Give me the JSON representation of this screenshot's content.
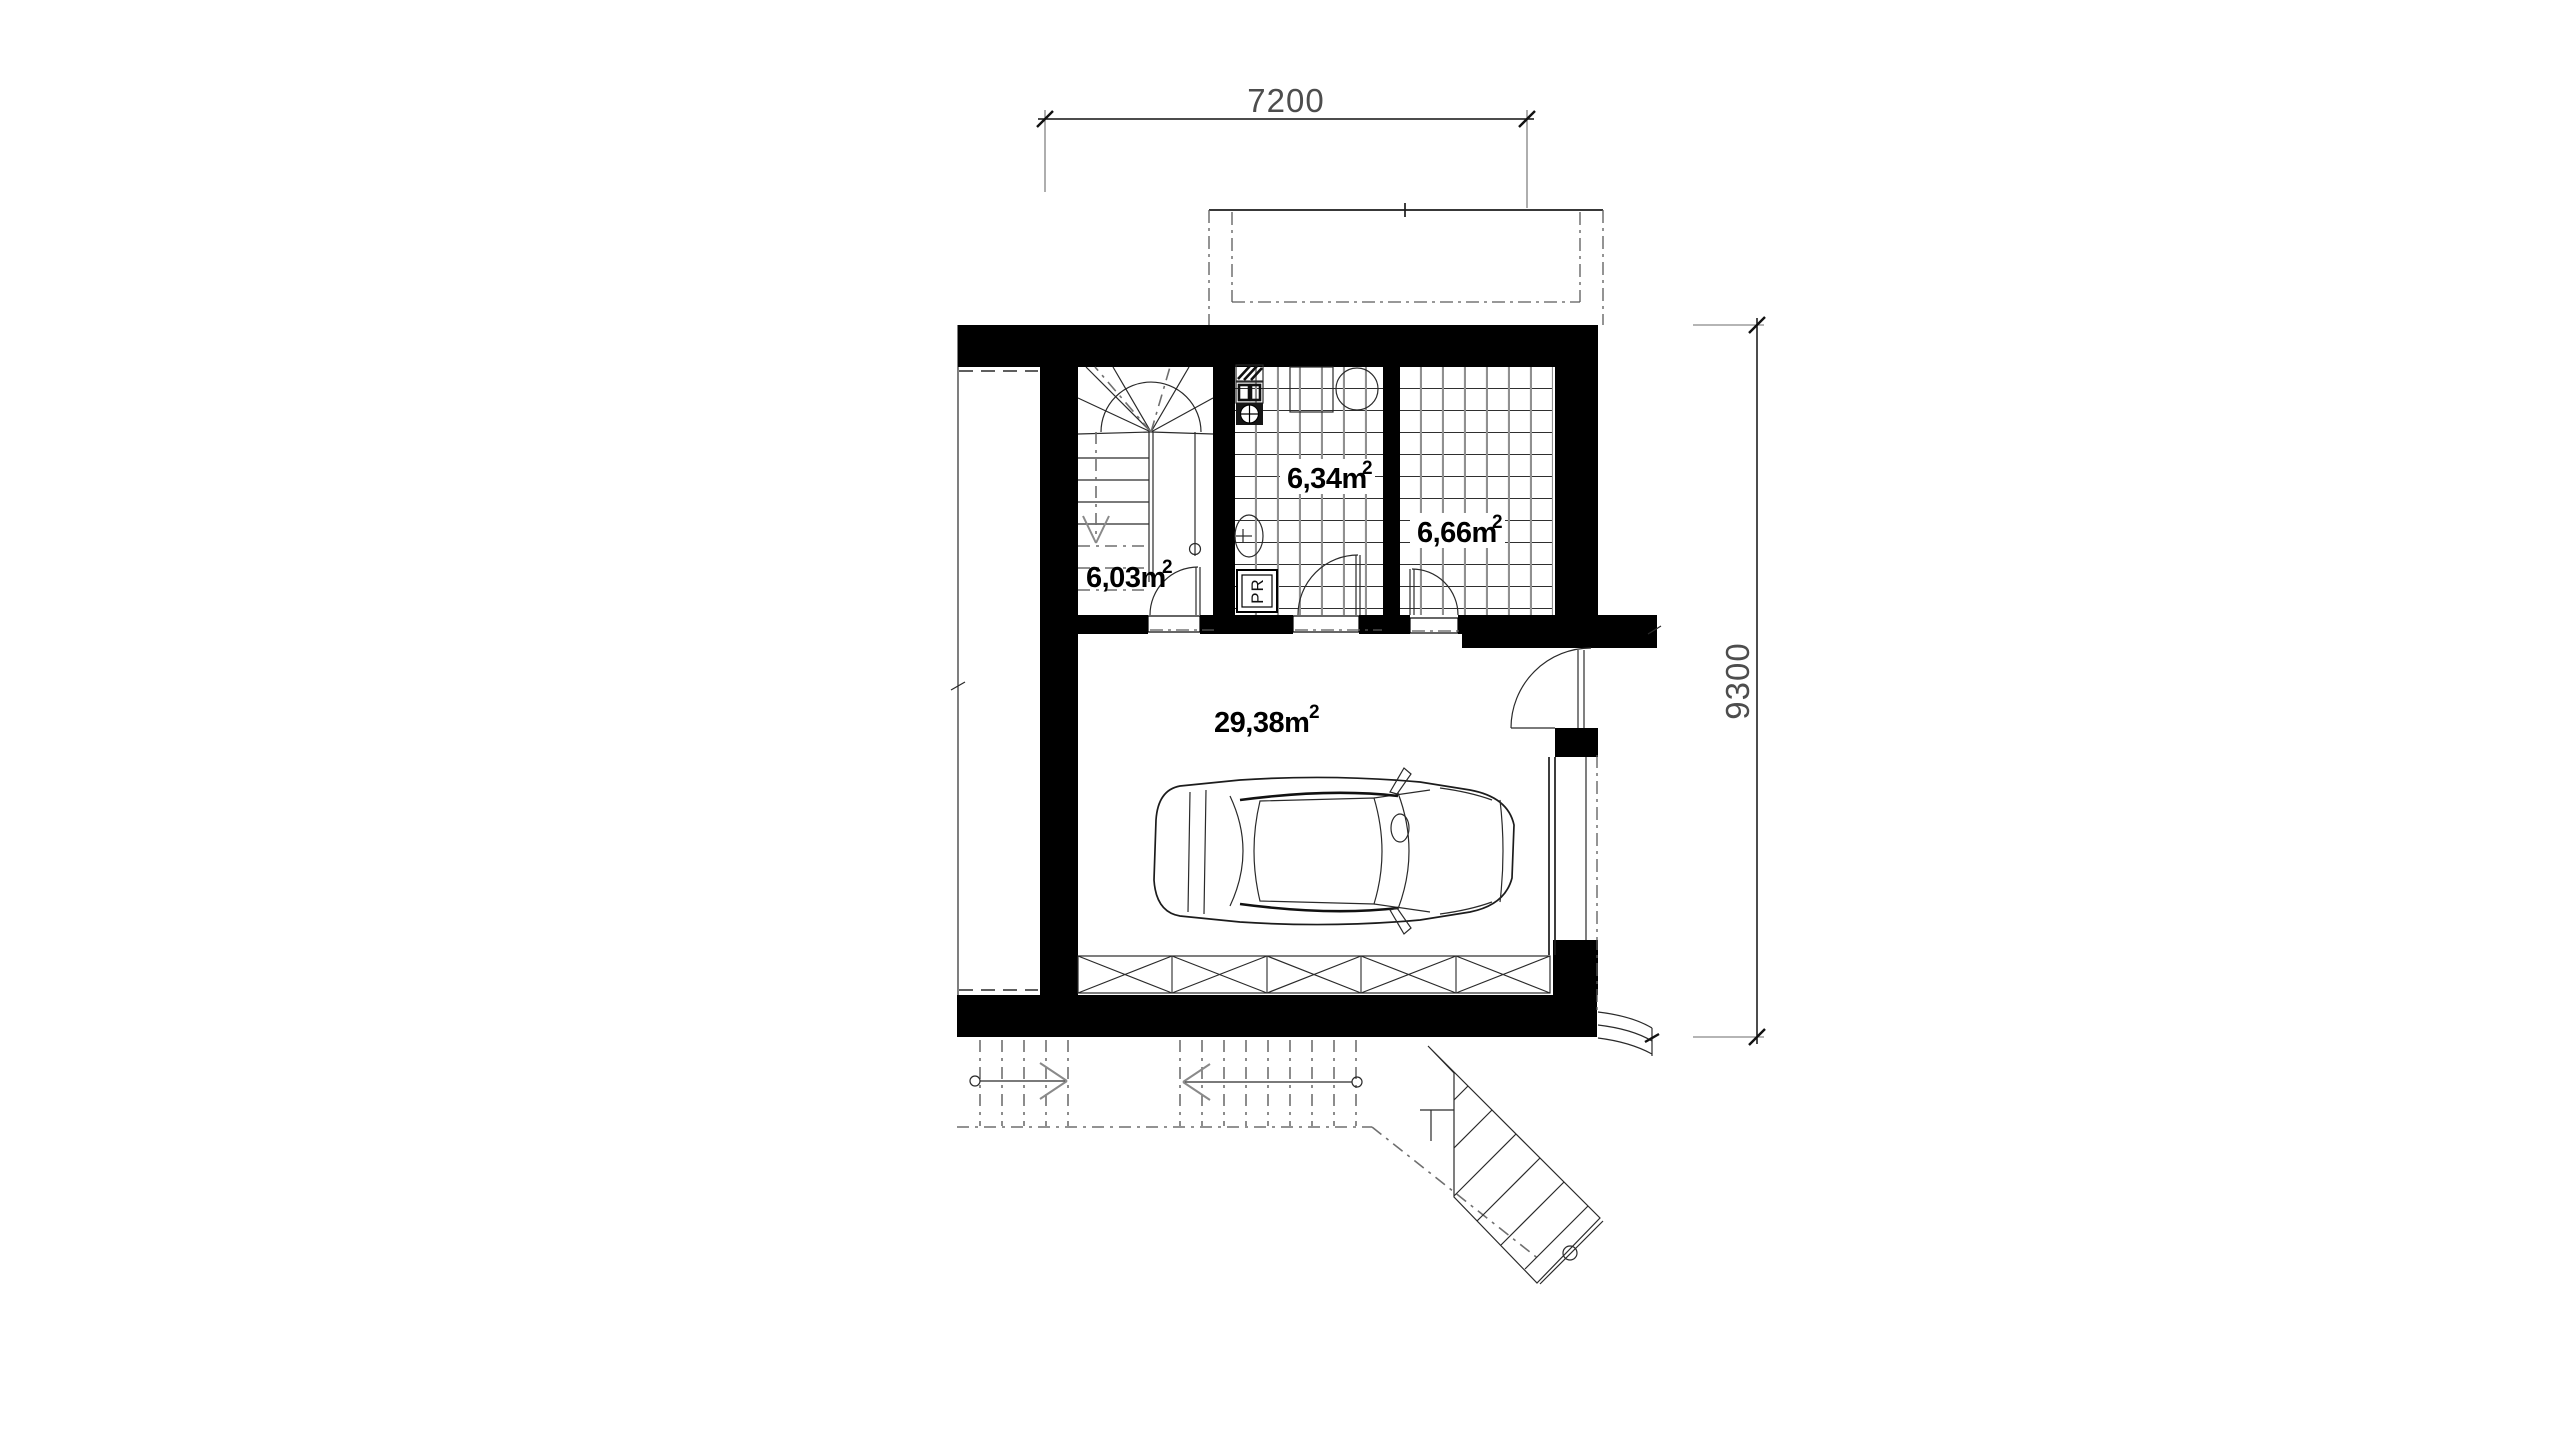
{
  "plan": {
    "dimensions": {
      "top": "7200",
      "right": "9300"
    },
    "rooms": [
      {
        "id": "stair-hall",
        "label": "6,03m",
        "sup": "2"
      },
      {
        "id": "utility-bath",
        "label": "6,34m",
        "sup": "2"
      },
      {
        "id": "storage-room",
        "label": "6,66m",
        "sup": "2"
      },
      {
        "id": "garage",
        "label": "29,38m",
        "sup": "2"
      }
    ],
    "appliances": {
      "washing_machine": "PR"
    },
    "colors": {
      "wall": "#000000",
      "line": "#1c1c1c",
      "gray_line": "#8a8a8a",
      "dim_text": "#4d4d4d",
      "background": "#ffffff"
    }
  }
}
